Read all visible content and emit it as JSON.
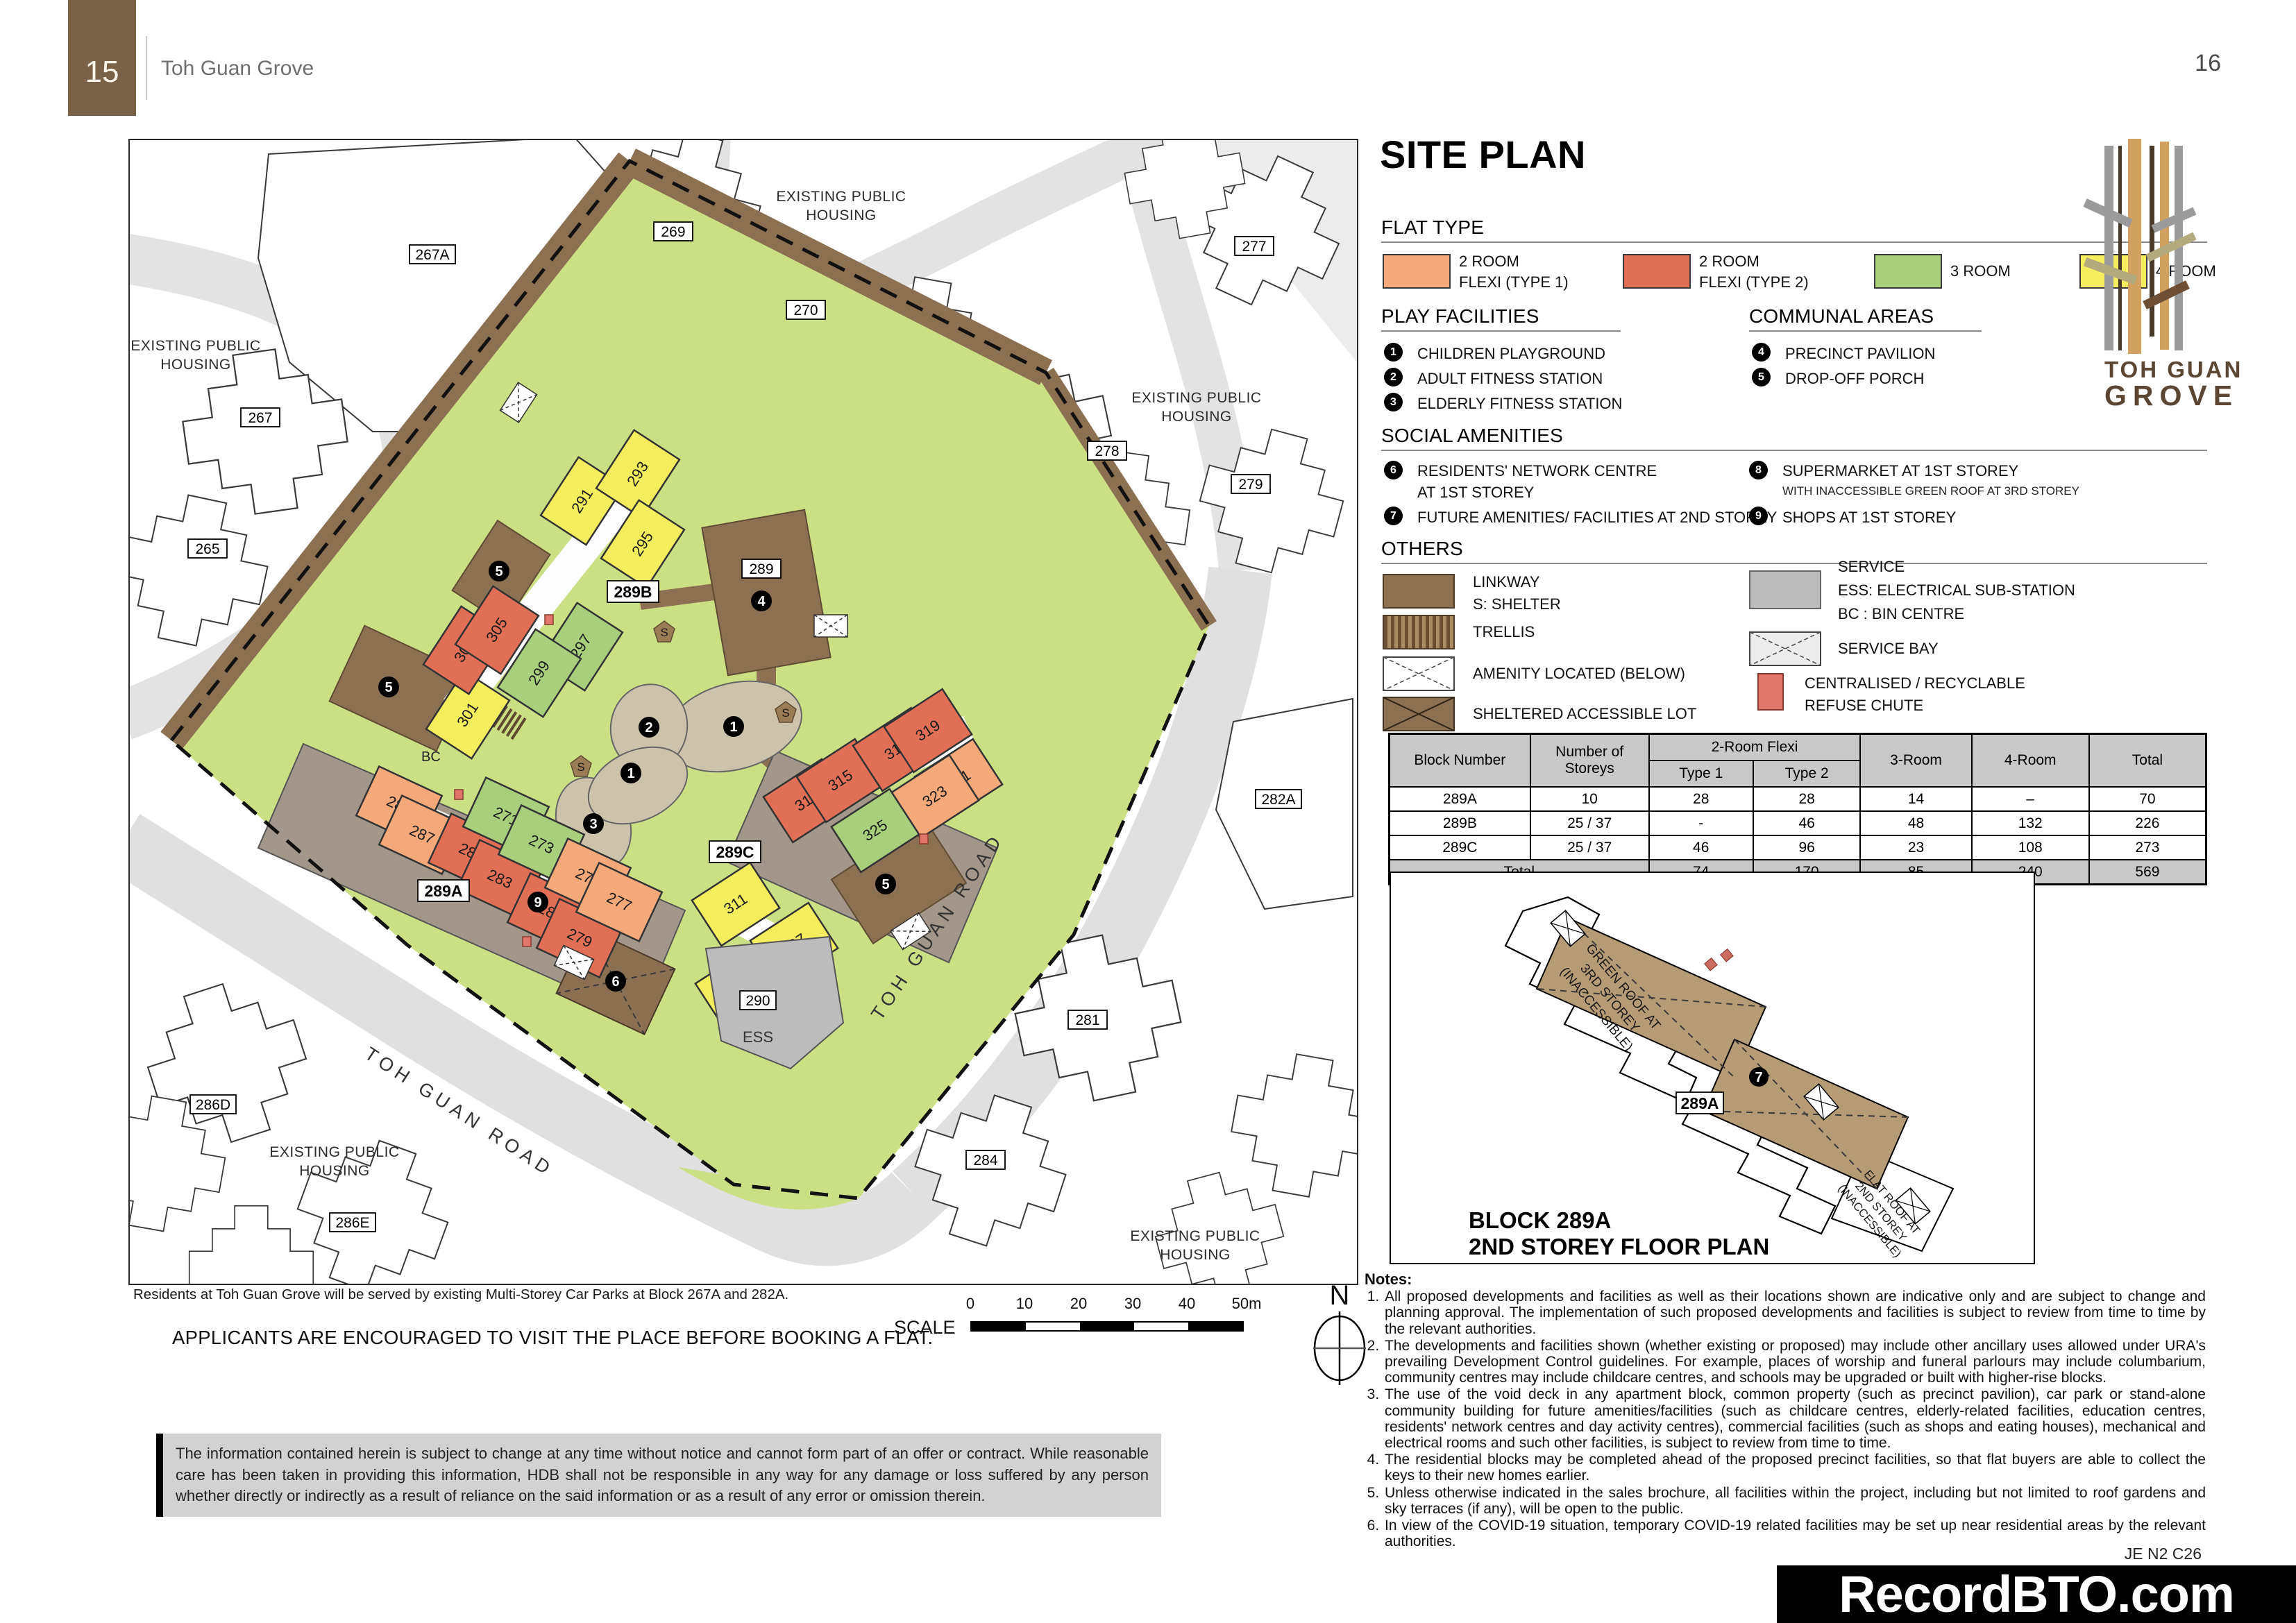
{
  "page": {
    "tab_number": "15",
    "tab_title": "Toh Guan Grove",
    "page_number": "16"
  },
  "colors": {
    "flat_type_1": "#f4a97a",
    "flat_type_2": "#e06f55",
    "room_3": "#a9cf7d",
    "room_4": "#f4ee5f",
    "linkway_brown": "#8b7052",
    "service_gray": "#bcbcbc",
    "refuse_red": "#e2766b",
    "site_green": "#cbdf85",
    "header_brown": "#7a6248"
  },
  "map": {
    "caption": "Residents at Toh Guan Grove will be served by existing Multi-Storey Car Parks at Block 267A and 282A.",
    "visit_notice": "APPLICANTS ARE ENCOURAGED TO VISIT THE PLACE BEFORE BOOKING A FLAT.",
    "scale_label": "SCALE",
    "scale_ticks": [
      "0",
      "10",
      "20",
      "30",
      "40",
      "50m"
    ],
    "north": "N",
    "road_label": "TOH GUAN ROAD",
    "area_line1": "EXISTING PUBLIC",
    "area_line2": "HOUSING",
    "blocks": [
      "267A",
      "269",
      "270",
      "277",
      "278",
      "279",
      "267",
      "265",
      "282A",
      "281",
      "284",
      "286D",
      "286E"
    ],
    "site_blocks": [
      "289A",
      "289B",
      "289C"
    ],
    "pavilion": "289",
    "ess_num": "290",
    "ess_label": "ESS",
    "bc_label": "BC",
    "shelter": "S",
    "units": [
      "291",
      "293",
      "295",
      "297",
      "299",
      "301",
      "303",
      "305",
      "313",
      "315",
      "317",
      "319",
      "321",
      "323",
      "325",
      "311",
      "307",
      "309",
      "289",
      "287",
      "285",
      "283",
      "281",
      "279",
      "271",
      "273",
      "275",
      "277"
    ],
    "markers": {
      "m1": "1",
      "m2": "2",
      "m3": "3",
      "m4": "4",
      "m5": "5",
      "m6": "6",
      "m9": "9"
    }
  },
  "panel": {
    "title": "SITE PLAN",
    "flat_type": {
      "title": "FLAT TYPE",
      "items": [
        {
          "line1": "2 ROOM",
          "line2": "FLEXI (TYPE 1)"
        },
        {
          "line1": "2 ROOM",
          "line2": "FLEXI (TYPE 2)"
        },
        {
          "line1": "3 ROOM",
          "line2": ""
        },
        {
          "line1": "4 ROOM",
          "line2": ""
        }
      ]
    },
    "play_facilities": {
      "title": "PLAY FACILITIES",
      "items": [
        {
          "num": "1",
          "label": "CHILDREN PLAYGROUND"
        },
        {
          "num": "2",
          "label": "ADULT FITNESS STATION"
        },
        {
          "num": "3",
          "label": "ELDERLY FITNESS STATION"
        }
      ]
    },
    "communal_areas": {
      "title": "COMMUNAL AREAS",
      "items": [
        {
          "num": "4",
          "label": "PRECINCT PAVILION"
        },
        {
          "num": "5",
          "label": "DROP-OFF PORCH"
        }
      ]
    },
    "social_amenities": {
      "title": "SOCIAL AMENITIES",
      "items": [
        {
          "num": "6",
          "label": "RESIDENTS' NETWORK CENTRE",
          "label2": "AT 1ST STOREY"
        },
        {
          "num": "7",
          "label": "FUTURE AMENITIES/ FACILITIES AT 2ND STOREY",
          "label2": ""
        },
        {
          "num": "8",
          "label": "SUPERMARKET AT 1ST STOREY",
          "label2": "WITH INACCESSIBLE GREEN ROOF AT 3RD STOREY"
        },
        {
          "num": "9",
          "label": "SHOPS AT 1ST STOREY",
          "label2": ""
        }
      ]
    },
    "others": {
      "title": "OTHERS",
      "linkway": {
        "label": "LINKWAY",
        "label2": "S:  SHELTER"
      },
      "trellis": {
        "label": "TRELLIS"
      },
      "amenity": {
        "label": "AMENITY LOCATED (BELOW)"
      },
      "sheltered": {
        "label": "SHELTERED ACCESSIBLE LOT"
      },
      "service": {
        "label": "SERVICE",
        "label2": "ESS: ELECTRICAL SUB-STATION",
        "label3": "BC  : BIN CENTRE"
      },
      "service_bay": {
        "label": "SERVICE BAY"
      },
      "refuse": {
        "label": "CENTRALISED / RECYCLABLE",
        "label2": "REFUSE CHUTE"
      }
    }
  },
  "table": {
    "col_block": "Block Number",
    "col_storeys_1": "Number of",
    "col_storeys_2": "Storeys",
    "col_2room": "2-Room Flexi",
    "col_type1": "Type 1",
    "col_type2": "Type 2",
    "col_3room": "3-Room",
    "col_4room": "4-Room",
    "col_total": "Total",
    "rows": [
      {
        "block": "289A",
        "storeys": "10",
        "t1": "28",
        "t2": "28",
        "r3": "14",
        "r4": "–",
        "total": "70"
      },
      {
        "block": "289B",
        "storeys": "25 / 37",
        "t1": "-",
        "t2": "46",
        "r3": "48",
        "r4": "132",
        "total": "226"
      },
      {
        "block": "289C",
        "storeys": "25 / 37",
        "t1": "46",
        "t2": "96",
        "r3": "23",
        "r4": "108",
        "total": "273"
      }
    ],
    "total_label": "Total",
    "totals": {
      "t1": "74",
      "t2": "170",
      "r3": "85",
      "r4": "240",
      "total": "569"
    }
  },
  "floorplan": {
    "roof1_line1": "GREEN ROOF AT",
    "roof1_line2": "3RD STOREY",
    "roof1_line3": "(INACCESSIBLE)",
    "roof2_line1": "FLAT ROOF AT",
    "roof2_line2": "2ND STOREY",
    "roof2_line3": "(INACCESSIBLE)",
    "block_label": "289A",
    "marker": "7",
    "caption1": "BLOCK 289A",
    "caption2": "2ND STOREY FLOOR PLAN"
  },
  "notes": {
    "title": "Notes:",
    "items": [
      "All proposed developments and facilities as well as their locations shown are indicative only and are subject to change and planning approval. The implementation of such proposed developments and facilities is subject to review from time to time by the relevant authorities.",
      "The developments and facilities shown (whether existing or proposed) may include other ancillary uses allowed under URA's prevailing Development Control guidelines. For example, places of worship and funeral parlours may include columbarium, community centres may include childcare centres, and schools may be upgraded or built with higher-rise blocks.",
      "The use of the void deck in any apartment block, common property (such as precinct pavilion), car park or stand-alone community building for future amenities/facilities (such as childcare centres, elderly-related facilities, education centres, residents' network centres and day activity centres), commercial facilities (such as shops and eating houses), mechanical and electrical rooms and such other facilities, is subject to review from time to time.",
      "The residential blocks may be completed ahead of the proposed precinct facilities, so that flat buyers are able to collect the keys to their new homes earlier.",
      "Unless otherwise indicated in the sales brochure, all facilities within the project, including but not limited to roof gardens and sky terraces (if any), will be open to the public.",
      "In view of the COVID-19 situation, temporary COVID-19 related facilities may be set up near residential areas by the relevant authorities."
    ]
  },
  "footer": {
    "disclaimer": "The information contained herein is subject to change at any time without notice and cannot form part of an offer or contract. While reasonable care has been taken in providing this information, HDB shall not be responsible in any way for any damage or loss suffered by any person whether directly or indirectly as a result of reliance on the said information or as a result of any error or omission therein.",
    "code": "JE N2 C26",
    "watermark": "RecordBTO.com"
  },
  "logo": {
    "line1": "TOH GUAN",
    "line2": "GROVE"
  }
}
